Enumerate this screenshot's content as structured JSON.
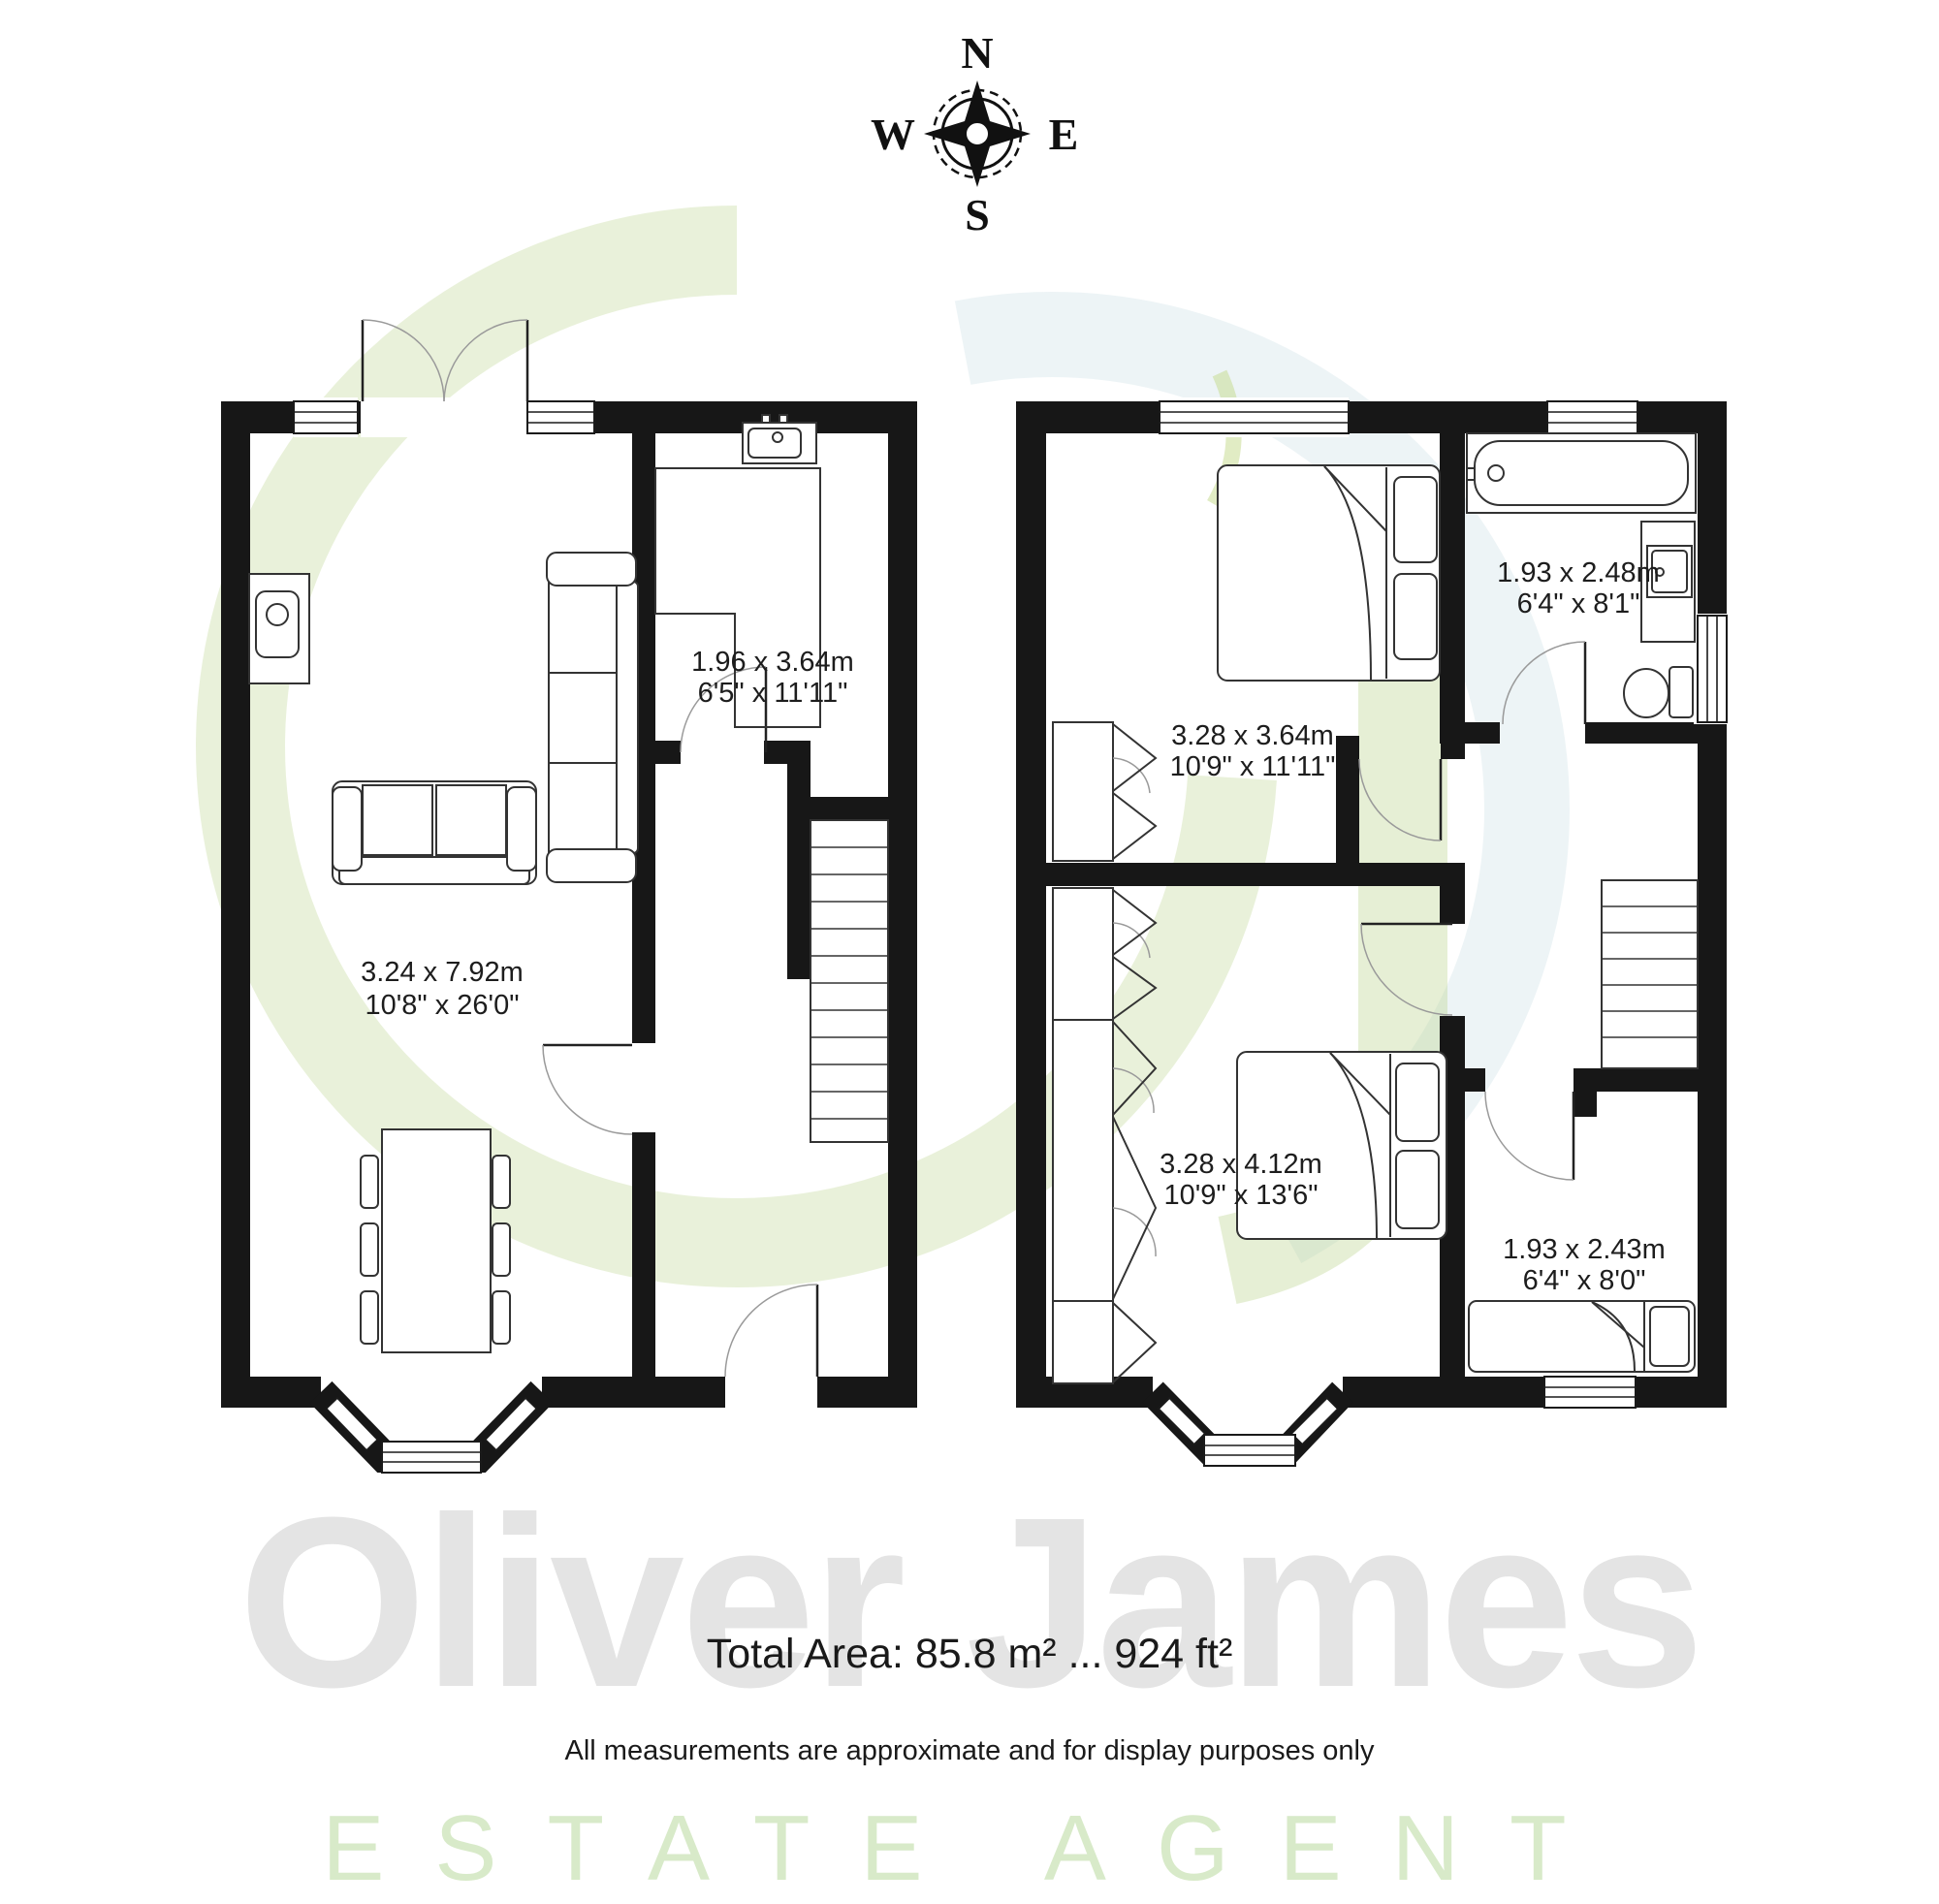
{
  "compass": {
    "n": "N",
    "e": "E",
    "s": "S",
    "w": "W"
  },
  "ground_floor": {
    "living_room": {
      "metric": "3.24 x 7.92m",
      "imperial": "10'8\" x 26'0\""
    },
    "kitchen": {
      "metric": "1.96 x 3.64m",
      "imperial": "6'5\" x 11'11\""
    }
  },
  "first_floor": {
    "bedroom1": {
      "metric": "3.28 x 3.64m",
      "imperial": "10'9\" x 11'11\""
    },
    "bathroom": {
      "metric": "1.93 x 2.48m",
      "imperial": "6'4\" x 8'1\""
    },
    "bedroom2": {
      "metric": "3.28 x 4.12m",
      "imperial": "10'9\" x 13'6\""
    },
    "bedroom3": {
      "metric": "1.93 x 2.43m",
      "imperial": "6'4\" x 8'0\""
    }
  },
  "footer": {
    "total_area": "Total Area: 85.8 m² ... 924 ft²",
    "disclaimer": "All measurements are approximate and for display purposes only"
  },
  "watermark": {
    "brand": "Oliver James",
    "tagline": "ESTATE AGENT"
  },
  "colors": {
    "wall": "#171717",
    "brand_green": "#b5cf85",
    "brand_blue": "#b3cfdb",
    "watermark_gray": "#e4e4e4",
    "tagline_green": "#d8eac9"
  }
}
